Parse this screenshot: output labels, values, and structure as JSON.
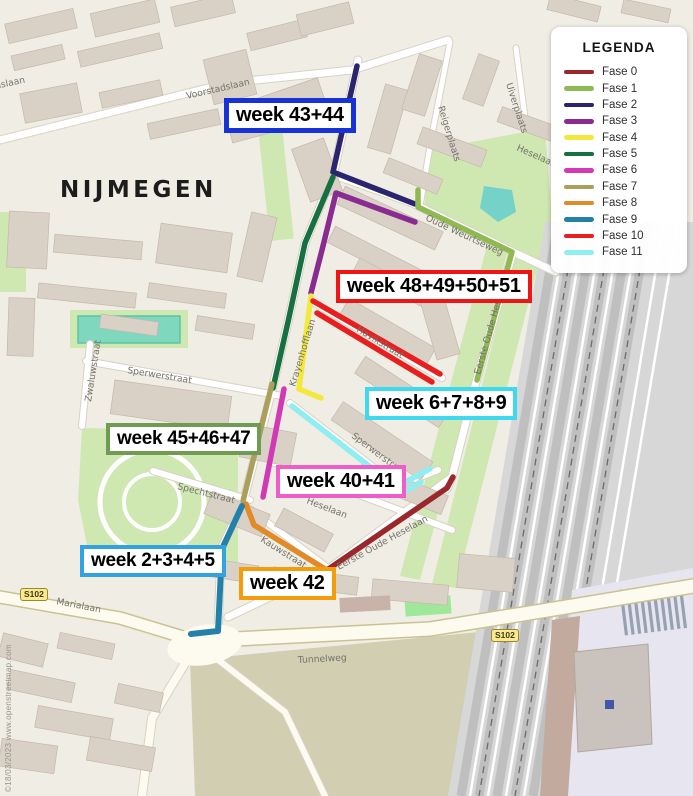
{
  "map": {
    "city_label": "NIJMEGEN",
    "watermark": "©18/03/2023 www.openstreetmap.com",
    "road_badge": "S102",
    "streets": [
      {
        "name": "Voorstadslaan"
      },
      {
        "name": "Oude Weurtseweg"
      },
      {
        "name": "Uiverplaats"
      },
      {
        "name": "Reigerplaats"
      },
      {
        "name": "Heselaan"
      },
      {
        "name": "Eerste Oude Heselaan"
      },
      {
        "name": "Zwaluwstraat"
      },
      {
        "name": "Sperwerstraat"
      },
      {
        "name": "Krayenhofflaan"
      },
      {
        "name": "Havikstraat"
      },
      {
        "name": "Spechtstraat"
      },
      {
        "name": "Kauwstraat"
      },
      {
        "name": "Marialaan"
      },
      {
        "name": "Tunnelweg"
      }
    ]
  },
  "legend": {
    "title": "LEGENDA",
    "items": [
      {
        "label": "Fase 0",
        "color": "#99272b"
      },
      {
        "label": "Fase 1",
        "color": "#8fba51"
      },
      {
        "label": "Fase 2",
        "color": "#2b2570"
      },
      {
        "label": "Fase 3",
        "color": "#8a2b91"
      },
      {
        "label": "Fase 4",
        "color": "#f2e93c"
      },
      {
        "label": "Fase 5",
        "color": "#177041"
      },
      {
        "label": "Fase 6",
        "color": "#d23ab5"
      },
      {
        "label": "Fase 7",
        "color": "#ab9f5b"
      },
      {
        "label": "Fase 8",
        "color": "#e08a28"
      },
      {
        "label": "Fase 9",
        "color": "#2380a8"
      },
      {
        "label": "Fase 10",
        "color": "#e81f1f"
      },
      {
        "label": "Fase 11",
        "color": "#8feef1"
      }
    ]
  },
  "week_labels": [
    {
      "text": "week 43+44",
      "border": "#1733d8"
    },
    {
      "text": "week 48+49+50+51",
      "border": "#ee1514"
    },
    {
      "text": "week 6+7+8+9",
      "border": "#3ed9ee"
    },
    {
      "text": "week 45+46+47",
      "border": "#6f9b52"
    },
    {
      "text": "week 40+41",
      "border": "#ef5ec6"
    },
    {
      "text": "week 2+3+4+5",
      "border": "#33a3e0"
    },
    {
      "text": "week 42",
      "border": "#f39d0d"
    }
  ]
}
